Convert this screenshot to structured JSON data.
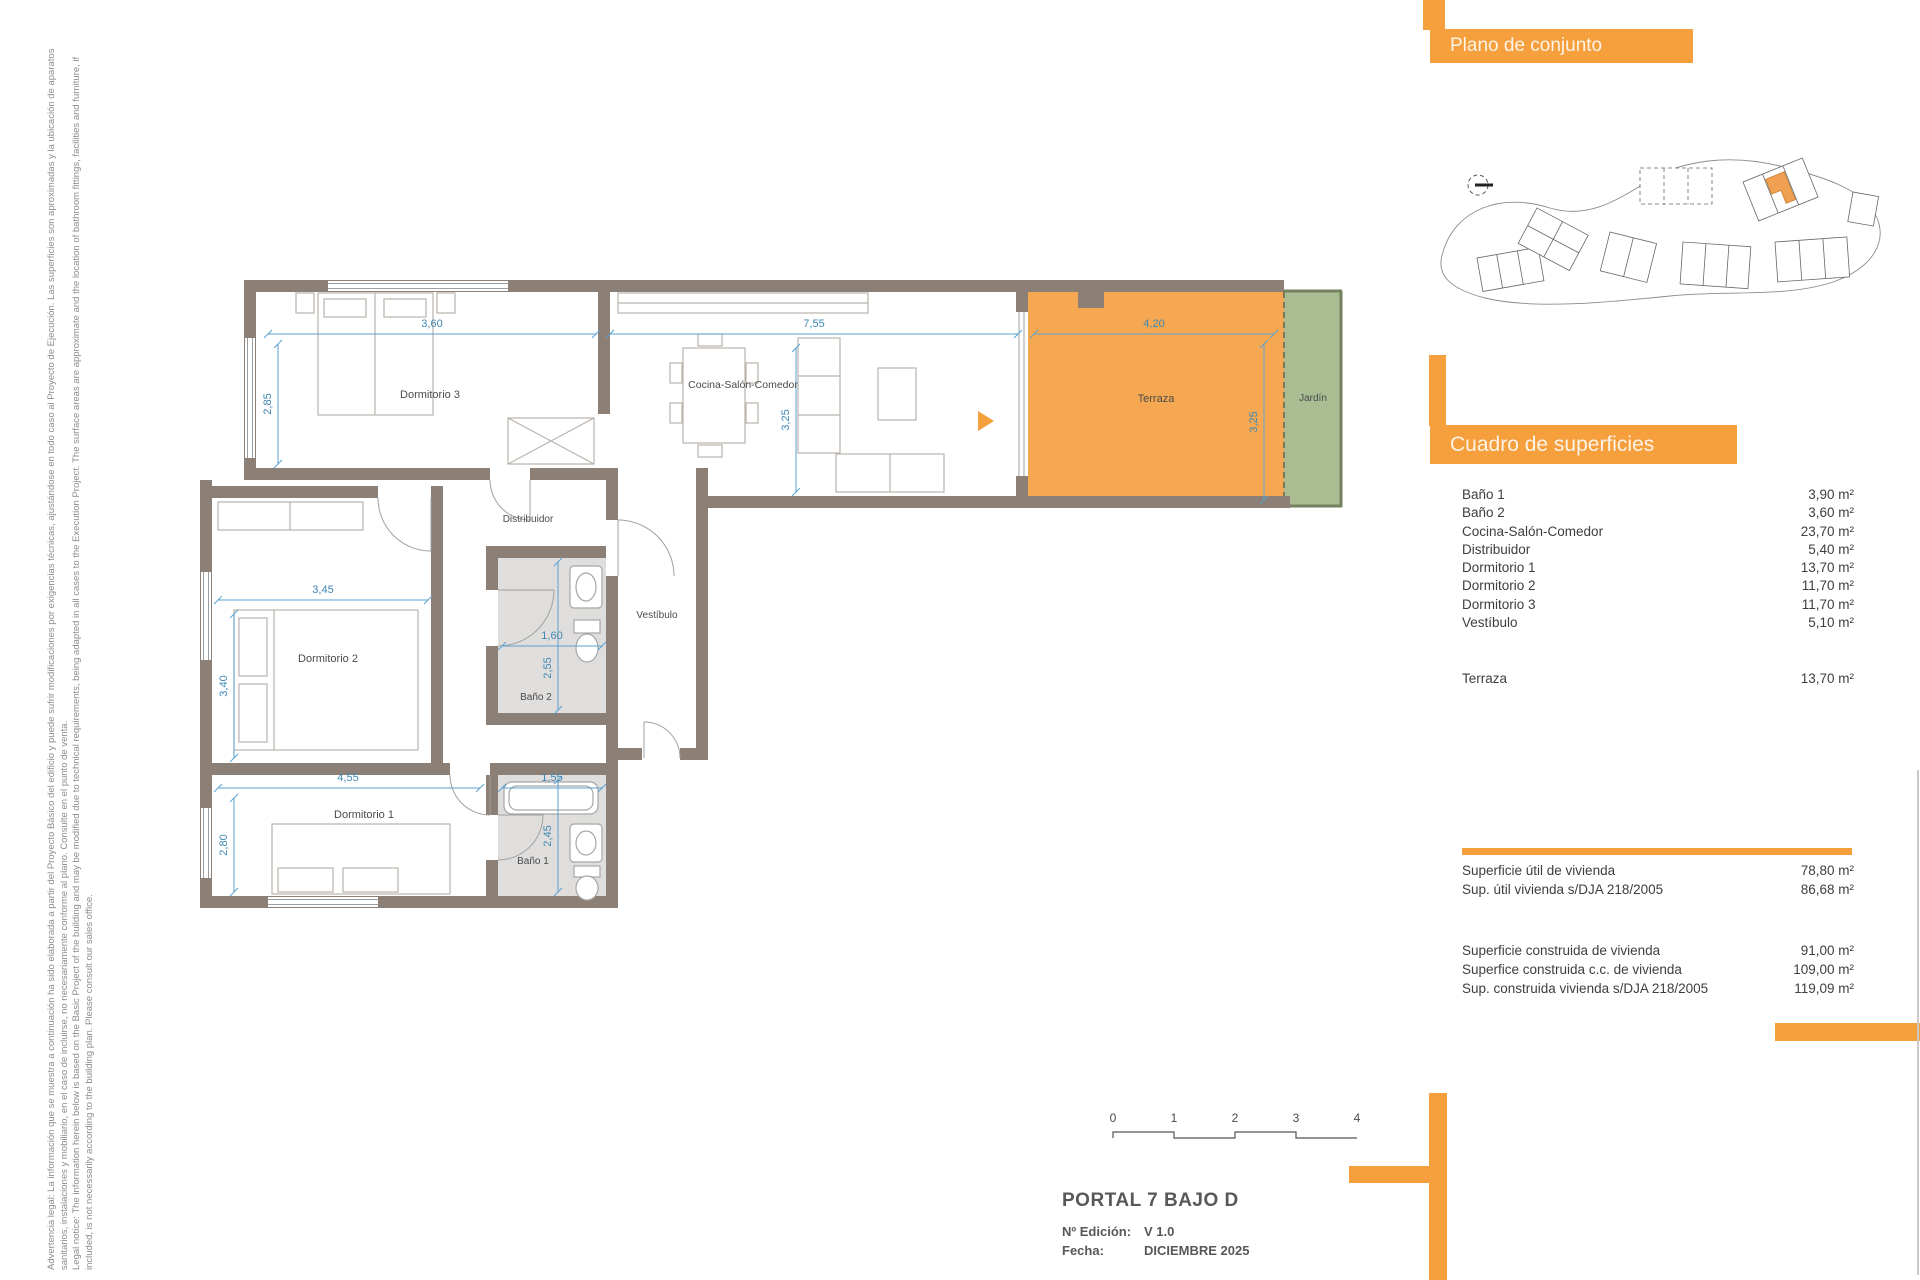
{
  "disclaimer": {
    "lines": [
      "Advertencia legal: La información que se muestra a continuación ha sido elaborada a partir del Proyecto Básico del edificio y puede sufrir modificaciones por exigencias técnicas, ajustándose en todo caso al Proyecto de Ejecución. Las superficies son aproximadas y la ubicación de aparatos",
      "sanitarios, instalaciones y mobiliario, en el caso de incluirse, no necesariamente conforme al plano. Consulte en el punto de venta.",
      "Legal notice: The information herein below is based on the Basic Project of the building and may be modified due to technical requirements, being adapted in all cases to the Execution Project. The surface areas are approximate and the location of bathroom fittings, facilities and furniture, if",
      "included, is not necessarily according to the building plan. Please consult our sales office."
    ]
  },
  "site_panel": {
    "title": "Plano de conjunto"
  },
  "surfaces_panel": {
    "title": "Cuadro de superficies",
    "rows": [
      {
        "label": "Baño 1",
        "value": "3,90 m²"
      },
      {
        "label": "Baño 2",
        "value": "3,60 m²"
      },
      {
        "label": "Cocina-Salón-Comedor",
        "value": "23,70 m²"
      },
      {
        "label": "Distribuidor",
        "value": "5,40 m²"
      },
      {
        "label": "Dormitorio 1",
        "value": "13,70 m²"
      },
      {
        "label": "Dormitorio 2",
        "value": "11,70 m²"
      },
      {
        "label": "Dormitorio 3",
        "value": "11,70 m²"
      },
      {
        "label": "Vestíbulo",
        "value": "5,10 m²"
      }
    ],
    "terraza_row": {
      "label": "Terraza",
      "value": "13,70 m²"
    },
    "totals_1": [
      {
        "label": "Superficie útil de vivienda",
        "value": "78,80 m²"
      },
      {
        "label": "Sup. útil vivienda s/DJA 218/2005",
        "value": "86,68 m²"
      }
    ],
    "totals_2": [
      {
        "label": "Superficie construida de vivienda",
        "value": "91,00 m²"
      },
      {
        "label": "Superfice construida c.c. de vivienda",
        "value": "109,00 m²"
      },
      {
        "label": "Sup. construida vivienda s/DJA 218/2005",
        "value": "119,09 m²"
      }
    ]
  },
  "plan": {
    "rooms": {
      "dorm3": "Dormitorio 3",
      "cocina": "Cocina-Salón-Comedor",
      "terraza": "Terraza",
      "jardin": "Jardín",
      "distribuidor": "Distribuidor",
      "vestibulo": "Vestíbulo",
      "dorm2": "Dormitorio 2",
      "bano2": "Baño 2",
      "dorm1": "Dormitorio 1",
      "bano1": "Baño 1"
    },
    "dims": {
      "dorm3_w": "3,60",
      "salon_w": "7,55",
      "terraza_w": "4,20",
      "dorm3_h": "2,85",
      "salon_h": "3,25",
      "terraza_h": "3,25",
      "dorm2_w": "3,45",
      "dorm2_h": "3,40",
      "bano2_w": "1,60",
      "bano2_h": "2,55",
      "dorm1_w": "4,55",
      "bano1_w": "1,55",
      "dorm1_h": "2,80",
      "bano1_h": "2,45"
    },
    "colors": {
      "wall": "#8c8076",
      "terraza": "#f5a851",
      "jardin": "#a9bc92",
      "dim_blue": "#3f88b5",
      "accent_orange": "#f59f3d"
    }
  },
  "scale_bar": {
    "ticks": [
      "0",
      "1",
      "2",
      "3",
      "4"
    ]
  },
  "title_block": {
    "title": "PORTAL 7 BAJO D",
    "edition_label": "Nº Edición:",
    "edition_value": "V 1.0",
    "date_label": "Fecha:",
    "date_value": "DICIEMBRE 2025"
  }
}
